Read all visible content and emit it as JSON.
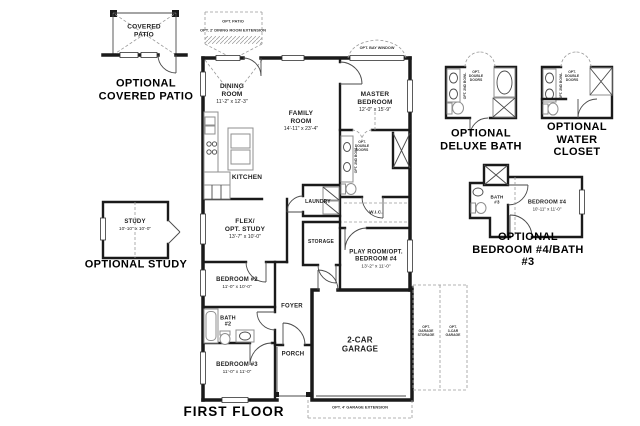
{
  "captions": {
    "covered_patio": "OPTIONAL\nCOVERED PATIO",
    "study": "OPTIONAL STUDY",
    "deluxe_bath": "OPTIONAL\nDELUXE BATH",
    "water_closet": "OPTIONAL\nWATER CLOSET",
    "bedroom4_bath3": "OPTIONAL\nBEDROOM #4/BATH #3",
    "first_floor": "FIRST FLOOR"
  },
  "rooms": {
    "covered_patio": {
      "name": "COVERED\nPATIO"
    },
    "dining": {
      "name": "DINING\nROOM",
      "dims": "11'-2\" x 12'-3\""
    },
    "family": {
      "name": "FAMILY\nROOM",
      "dims": "14'-11\" x 23'-4\""
    },
    "master": {
      "name": "MASTER\nBEDROOM",
      "dims": "12'-0\" x 15'-9\""
    },
    "kitchen": {
      "name": "KITCHEN"
    },
    "laundry": {
      "name": "LAUNDRY"
    },
    "wic": {
      "name": "W.I.C."
    },
    "flex": {
      "name": "FLEX/\nOPT. STUDY",
      "dims": "13'-7\" x 10'-0\""
    },
    "storage": {
      "name": "STORAGE"
    },
    "playroom": {
      "name": "PLAY ROOM/OPT.\nBEDROOM #4",
      "dims": "13'-2\" x 11'-0\""
    },
    "bedroom2": {
      "name": "BEDROOM #2",
      "dims": "11'-0\" x 10'-0\""
    },
    "bath2": {
      "name": "BATH\n#2"
    },
    "foyer": {
      "name": "FOYER"
    },
    "porch": {
      "name": "PORCH"
    },
    "bedroom3": {
      "name": "BEDROOM #3",
      "dims": "11'-0\" x 11'-0\""
    },
    "garage": {
      "name": "2-CAR\nGARAGE"
    },
    "study": {
      "name": "STUDY",
      "dims": "10'-10\" x 10'-0\""
    },
    "bath3": {
      "name": "BATH\n#3"
    },
    "bedroom4": {
      "name": "BEDROOM #4",
      "dims": "10'-11\" x 11'-0\""
    }
  },
  "options": {
    "opt_patio": "OPT. PATIO",
    "opt_dining_ext": "OPT. 2' DINING ROOM EXTENSION",
    "opt_bay_window": "OPT. BAY WINDOW",
    "opt_double_doors": "OPT.\nDOUBLE\nDOORS",
    "opt_2nd_bowl": "OPT. 2ND BOWL",
    "opt_garage_ext": "OPT. 4' GARAGE EXTENSION",
    "opt_garage_storage": "OPT.\nGARAGE\nSTORAGE",
    "opt_3car_garage": "OPT.\n3-CAR\nGARAGE"
  },
  "colors": {
    "wall": "#1a1a1a",
    "thin": "#4a4a4a",
    "dashed": "#9a9a9a",
    "fixture": "#8f8f8f",
    "text": "#1f1f1f"
  }
}
